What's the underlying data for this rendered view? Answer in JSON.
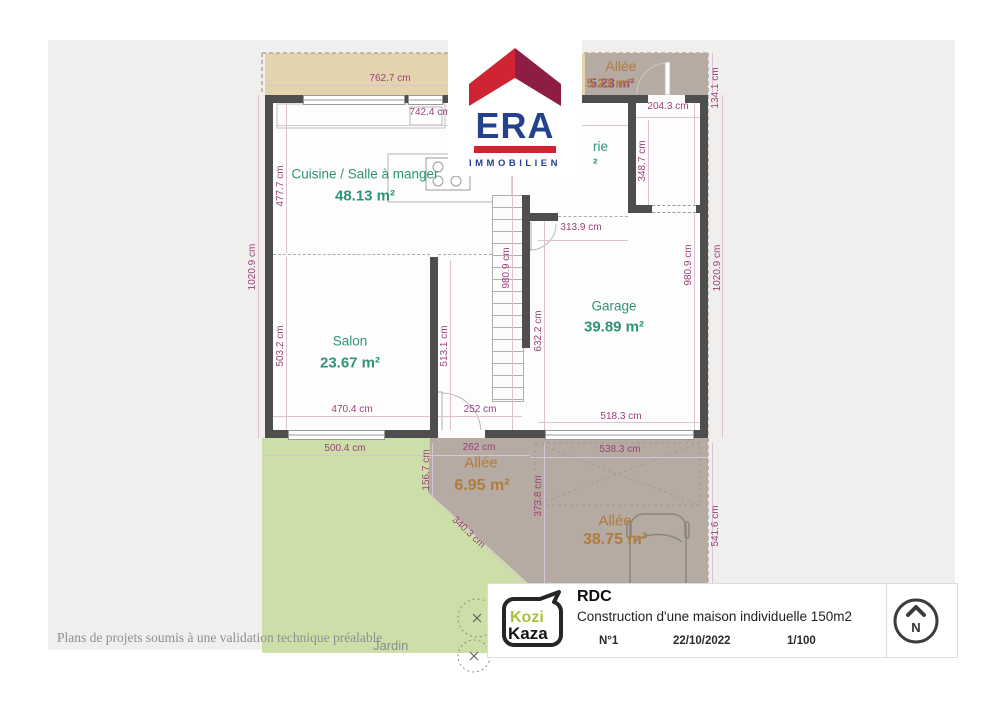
{
  "branding": {
    "era": {
      "name": "ERA",
      "subtitle": "IMMOBILIEN"
    },
    "kozikaza": {
      "line1": "Kozi",
      "line2": "Kaza"
    }
  },
  "title_block": {
    "floor": "RDC",
    "project": "Construction d'une maison individuelle 150m2",
    "number": "N°1",
    "date": "22/10/2022",
    "scale": "1/100",
    "north": "N"
  },
  "rooms": {
    "kitchen": {
      "name": "Cuisine / Salle à manger",
      "area": "48.13 m²"
    },
    "salon": {
      "name": "Salon",
      "area": "23.67 m²"
    },
    "garage": {
      "name": "Garage",
      "area": "39.89 m²"
    },
    "alley_top": {
      "name": "Allée",
      "area": "5.23 m²"
    },
    "alley_entrance": {
      "name": "Allée",
      "area": "6.95 m²"
    },
    "alley_driveway": {
      "name": "Allée",
      "area": "38.75 m²"
    },
    "laundry_partial": {
      "name_fragment": "rie",
      "area_fragment": "²"
    },
    "garden_label": "Jardin"
  },
  "dims": [
    "762.7 cm",
    "742.4 cm",
    "204.3 cm",
    "134.1 cm",
    "348.7 cm",
    "313.9 cm",
    "477.7 cm",
    "1020.9 cm",
    "1020.9 cm",
    "980.9 cm",
    "980.9 cm",
    "632.2 cm",
    "503.2 cm",
    "513.1 cm",
    "470.4 cm",
    "252 cm",
    "518.3 cm",
    "500.4 cm",
    "262 cm",
    "538.3 cm",
    "156.7 cm",
    "373.8 cm",
    "340.3 cm",
    "541.6 cm"
  ],
  "footer": {
    "disclaimer": "Plans de projets soumis à une validation technique préalable"
  },
  "colors": {
    "wall": "#4e4e4e",
    "dimension_text": "#9c4078",
    "room_text": "#2e9478",
    "alley_text": "#b07c3c",
    "terrace": "#e3d4ad",
    "driveway": "#b5aba2",
    "garden": "#cddfa8",
    "era_red": "#d02433",
    "era_dark_red": "#8e1d45",
    "era_blue": "#24418e",
    "kozikaza_green": "#a9c23a"
  }
}
